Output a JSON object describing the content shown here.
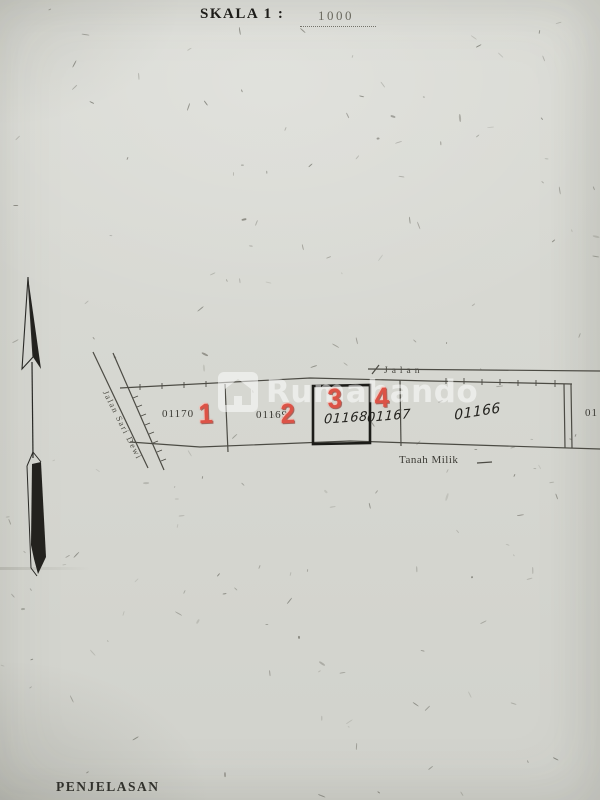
{
  "title": {
    "label": "SKALA 1 :",
    "value": "1000"
  },
  "map": {
    "road_left_label": "Jalan Sari Dewi",
    "road_top_label": "Jalan",
    "bottom_label": "Tanah Milik",
    "plots": [
      {
        "id": "01170",
        "overlay": "1"
      },
      {
        "id": "01169",
        "overlay": "2"
      },
      {
        "id": "01168",
        "overlay": "3",
        "highlighted": true
      },
      {
        "id": "01167",
        "overlay": "4"
      },
      {
        "id": "01166",
        "overlay": ""
      },
      {
        "id": "01",
        "overlay": ""
      }
    ],
    "north_arrow": "north-arrow"
  },
  "watermark": {
    "text": "Rumahando",
    "icon": "house-icon"
  },
  "footer": {
    "heading": "PENJELASAN"
  },
  "colors": {
    "paper": "#d6d7d1",
    "line_ink": "#4c4b44",
    "highlight_box": "#1c1c18",
    "overlay_red": "#dc5347",
    "watermark_white": "rgba(255,255,255,0.52)"
  }
}
